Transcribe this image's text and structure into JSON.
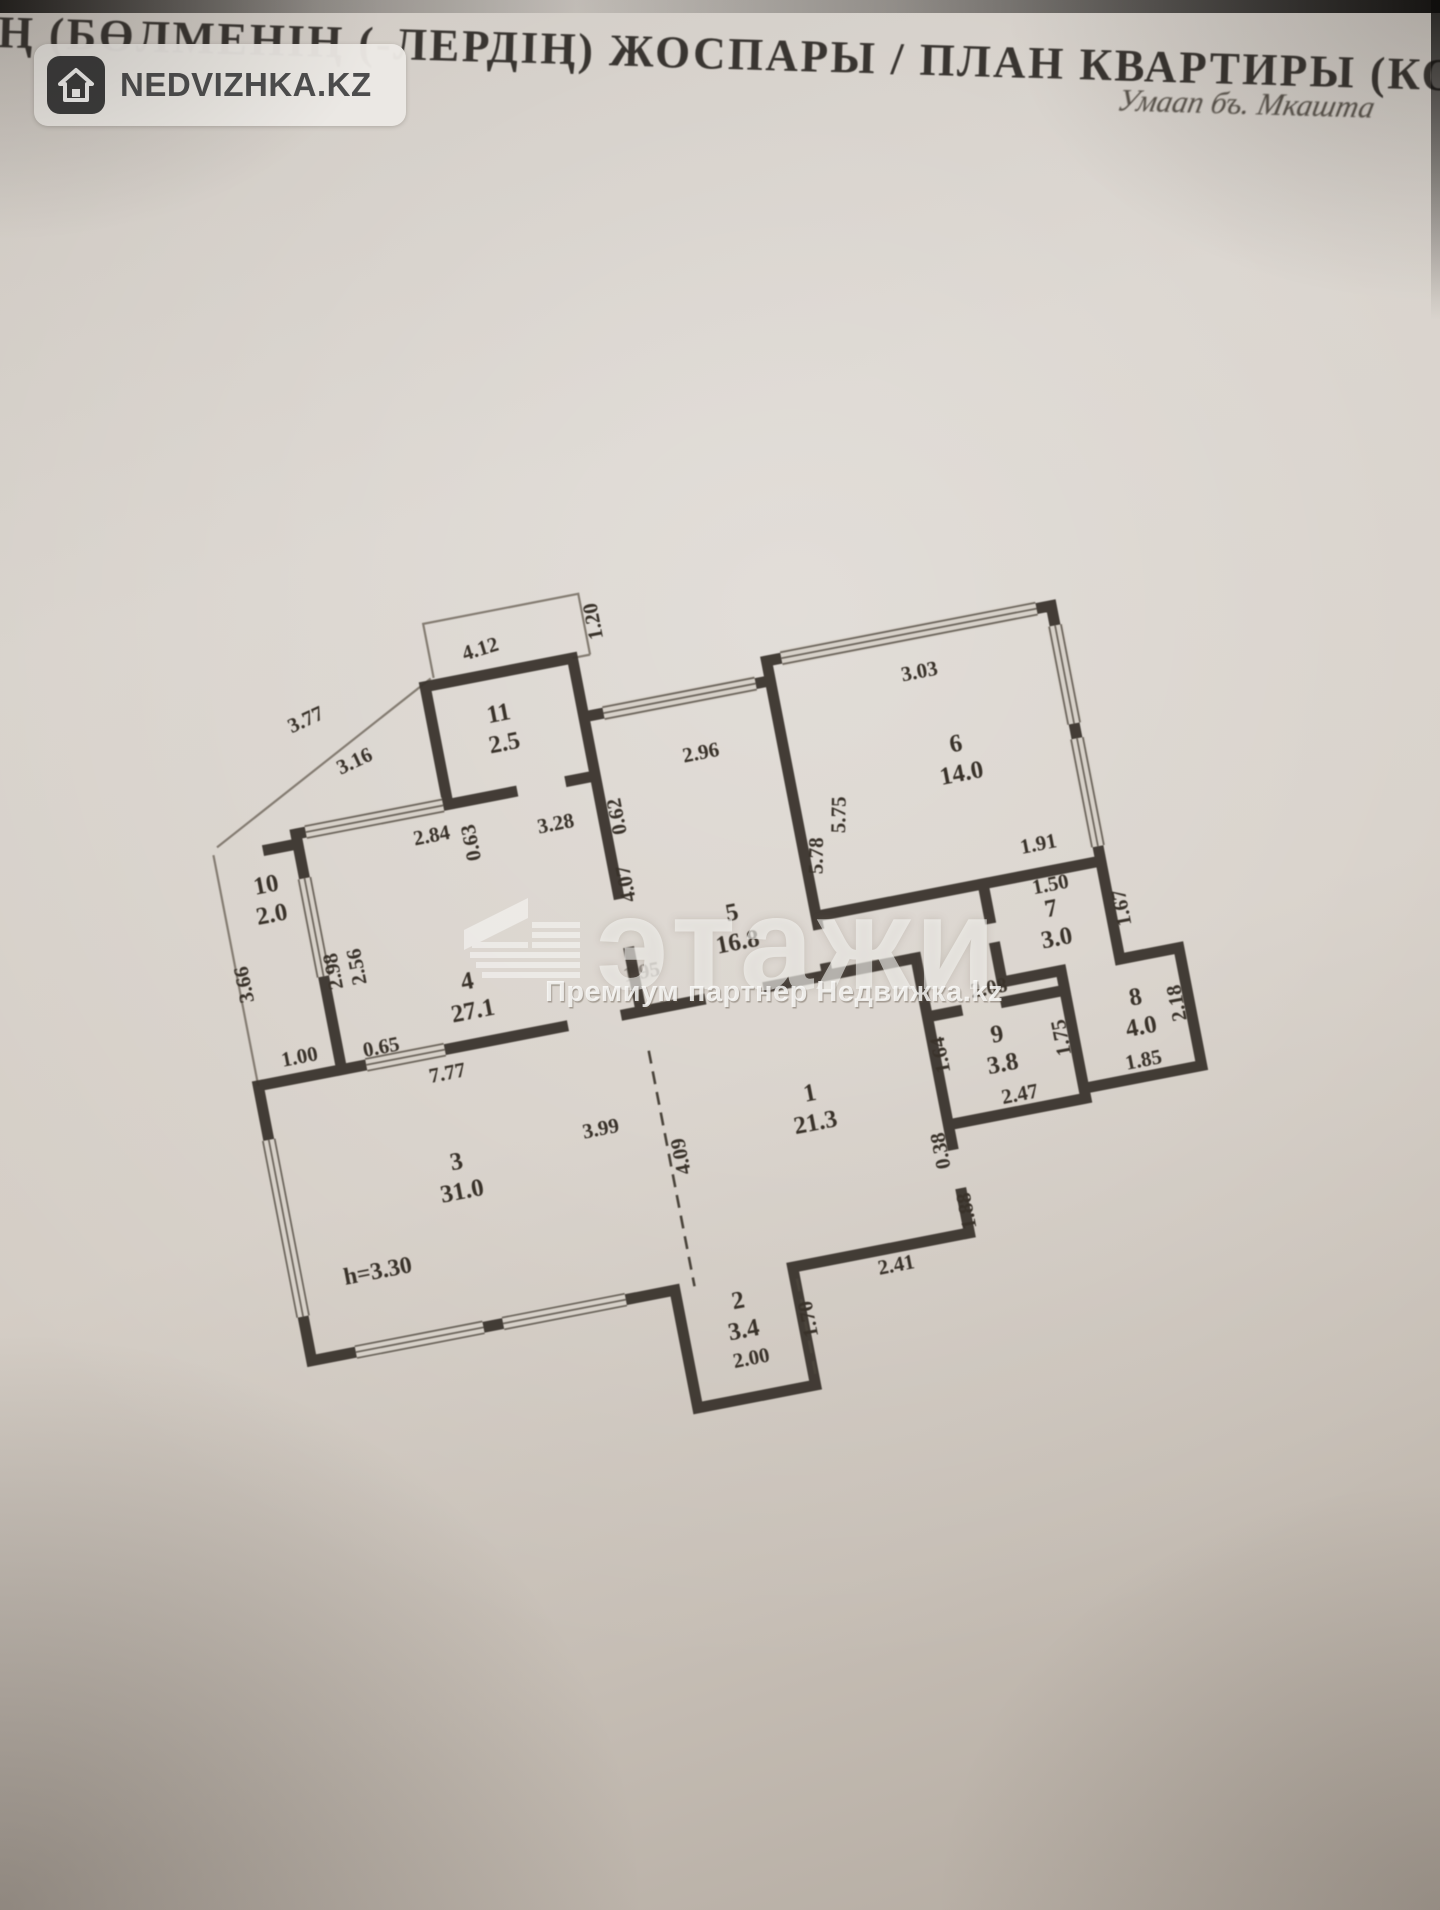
{
  "header": {
    "title": "РДІҢ (БӨЛМЕНІҢ (-ЛЕРДІҢ) ЖОСПАРЫ / ПЛАН КВАРТИРЫ (КОМ",
    "handwritten_note": "Умаап бъ. Мкашта"
  },
  "logo": {
    "brand": "NEDVIZHKA.KZ"
  },
  "watermark": {
    "brand": "этажи",
    "subtitle": "Премиум партнер Недвижка.kz"
  },
  "plan": {
    "height_note": {
      "t": "h=3.30",
      "x": 332,
      "y": 1212
    },
    "rooms": [
      {
        "n": "1",
        "area": "21.3",
        "x": 790,
        "y": 1120
      },
      {
        "n": "2",
        "area": "3.4",
        "x": 680,
        "y": 1310
      },
      {
        "n": "3",
        "area": "31.0",
        "x": 430,
        "y": 1120
      },
      {
        "n": "4",
        "area": "27.1",
        "x": 475,
        "y": 945
      },
      {
        "n": "5",
        "area": "16.8",
        "x": 748,
        "y": 928
      },
      {
        "n": "6",
        "area": "14.0",
        "x": 1000,
        "y": 805
      },
      {
        "n": "7",
        "area": "3.0",
        "x": 1062,
        "y": 985
      },
      {
        "n": "8",
        "area": "4.0",
        "x": 1128,
        "y": 1088
      },
      {
        "n": "9",
        "area": "3.8",
        "x": 985,
        "y": 1098
      },
      {
        "n": "10",
        "area": "2.0",
        "x": 296,
        "y": 812
      },
      {
        "n": "11",
        "area": "2.5",
        "x": 557,
        "y": 688
      }
    ],
    "dims": [
      {
        "t": "3.77",
        "x": 368,
        "y": 656,
        "r": -14
      },
      {
        "t": "3.16",
        "x": 408,
        "y": 706,
        "r": -14
      },
      {
        "t": "2.84",
        "x": 468,
        "y": 794,
        "r": 0
      },
      {
        "t": "0.63",
        "x": 512,
        "y": 802,
        "r": -90
      },
      {
        "t": "4.12",
        "x": 552,
        "y": 620,
        "r": -6
      },
      {
        "t": "3.28",
        "x": 592,
        "y": 806,
        "r": 0
      },
      {
        "t": "1.20",
        "x": 674,
        "y": 608,
        "r": -90
      },
      {
        "t": "0.62",
        "x": 660,
        "y": 804,
        "r": -90
      },
      {
        "t": "2.96",
        "x": 748,
        "y": 764,
        "r": 0
      },
      {
        "t": "4.07",
        "x": 656,
        "y": 872,
        "r": -90
      },
      {
        "t": "5.78",
        "x": 848,
        "y": 882,
        "r": -78
      },
      {
        "t": "5.75",
        "x": 878,
        "y": 846,
        "r": -78
      },
      {
        "t": "3.03",
        "x": 978,
        "y": 726,
        "r": 0
      },
      {
        "t": "1.91",
        "x": 1062,
        "y": 918,
        "r": 0
      },
      {
        "t": "1.50",
        "x": 1066,
        "y": 960,
        "r": 0
      },
      {
        "t": "1.67",
        "x": 1138,
        "y": 990,
        "r": -90
      },
      {
        "t": "2.18",
        "x": 1174,
        "y": 1094,
        "r": -90
      },
      {
        "t": "1.85",
        "x": 1124,
        "y": 1150,
        "r": 0
      },
      {
        "t": "2.08",
        "x": 986,
        "y": 1050,
        "r": 0
      },
      {
        "t": "1.75",
        "x": 1054,
        "y": 1106,
        "r": -90
      },
      {
        "t": "1.64",
        "x": 932,
        "y": 1100,
        "r": -90
      },
      {
        "t": "2.47",
        "x": 996,
        "y": 1160,
        "r": 0
      },
      {
        "t": "0.38",
        "x": 914,
        "y": 1194,
        "r": -90
      },
      {
        "t": "1.88",
        "x": 928,
        "y": 1258,
        "r": -90
      },
      {
        "t": "2.41",
        "x": 842,
        "y": 1304,
        "r": 0
      },
      {
        "t": "1.70",
        "x": 752,
        "y": 1334,
        "r": -90
      },
      {
        "t": "2.00",
        "x": 682,
        "y": 1368,
        "r": 0
      },
      {
        "t": "3.99",
        "x": 578,
        "y": 1114,
        "r": 0
      },
      {
        "t": "4.09",
        "x": 658,
        "y": 1150,
        "r": -90
      },
      {
        "t": "7.77",
        "x": 438,
        "y": 1030,
        "r": 0
      },
      {
        "t": "0.65",
        "x": 378,
        "y": 992,
        "r": 0
      },
      {
        "t": "1.00",
        "x": 296,
        "y": 986,
        "r": 0
      },
      {
        "t": "2.98",
        "x": 352,
        "y": 902,
        "r": -90
      },
      {
        "t": "2.56",
        "x": 376,
        "y": 902,
        "r": -90
      },
      {
        "t": "3.66",
        "x": 262,
        "y": 898,
        "r": -90
      },
      {
        "t": "1.95",
        "x": 648,
        "y": 968,
        "r": 0,
        "faint": true
      }
    ]
  }
}
